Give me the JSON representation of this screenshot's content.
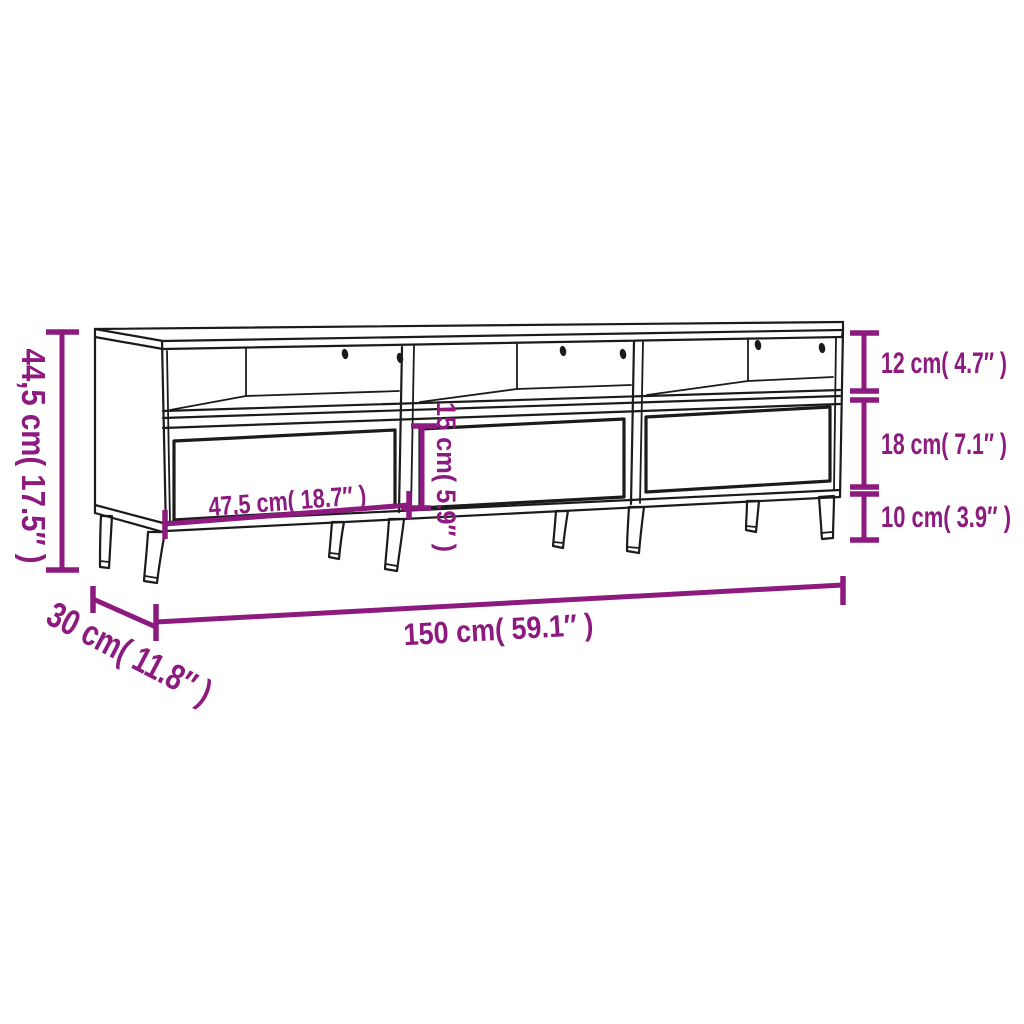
{
  "diagram": {
    "title": "TV cabinet dimension drawing",
    "subject": "TV stand with three open compartments, three drawers and splayed metal legs",
    "colors": {
      "dimension": "#8d1a7f",
      "outline": "#1b1b1b",
      "background": "#ffffff"
    },
    "dimensions": {
      "total_height": {
        "label": "44,5 cm( 17.5″ )",
        "cm": "44,5",
        "inch": "17.5",
        "placement": "left-vertical"
      },
      "top_compartment": {
        "label": "12 cm( 4.7″ )",
        "cm": "12",
        "inch": "4.7",
        "placement": "right-top"
      },
      "drawer_front": {
        "label": "18 cm( 7.1″ )",
        "cm": "18",
        "inch": "7.1",
        "placement": "right-middle"
      },
      "leg_height": {
        "label": "10 cm( 3.9″ )",
        "cm": "10",
        "inch": "3.9",
        "placement": "right-bottom"
      },
      "drawer_width": {
        "label": "47,5 cm( 18.7″ )",
        "cm": "47,5",
        "inch": "18.7",
        "placement": "on-left-drawer"
      },
      "drawer_inner_height": {
        "label": "15 cm( 5.9″ )",
        "cm": "15",
        "inch": "5.9",
        "placement": "center-vertical"
      },
      "total_width": {
        "label": "150 cm( 59.1″ )",
        "cm": "150",
        "inch": "59.1",
        "placement": "bottom-horizontal"
      },
      "total_depth": {
        "label": "30 cm( 11.8″ )",
        "cm": "30",
        "inch": "11.8",
        "placement": "bottom-left-diagonal"
      }
    }
  }
}
